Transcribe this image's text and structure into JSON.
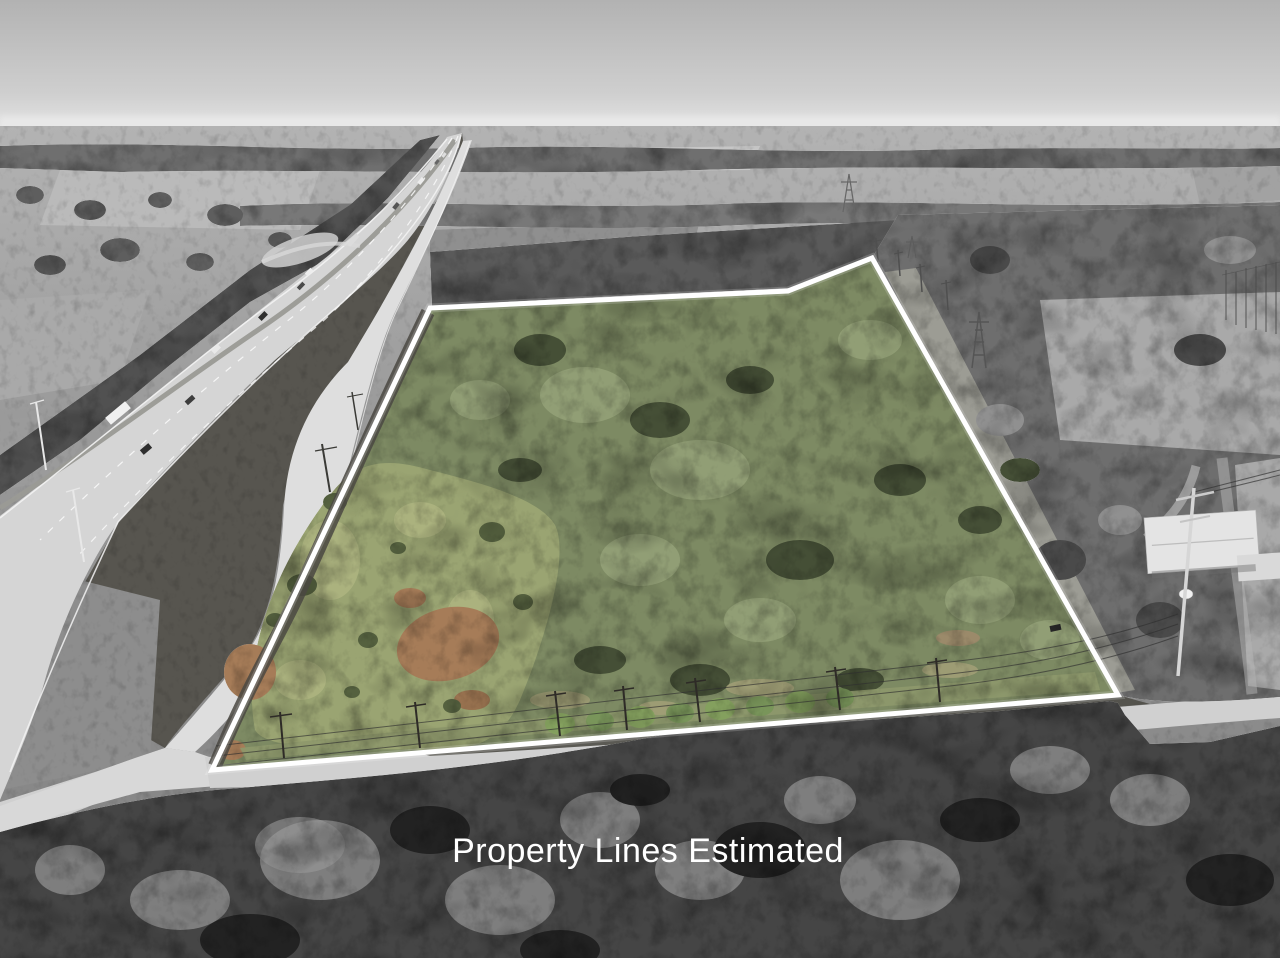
{
  "caption": {
    "text": "Property Lines Estimated",
    "color": "#ffffff"
  },
  "overlay": {
    "boundary_color": "#ffffff",
    "boundary_style": "solid",
    "note": "property interior shown in color, surroundings desaturated"
  },
  "palette": {
    "sky_gray": "#b4b4b4",
    "haze_white": "#e9e9e9",
    "field_gray": "#a8a8a8",
    "tree_gray": "#5f5f5f",
    "road_concrete": "#d5d5d5",
    "canopy_green": "#7d8a63",
    "clearing_green": "#9aa472",
    "dirt_brown": "#a67c58"
  }
}
